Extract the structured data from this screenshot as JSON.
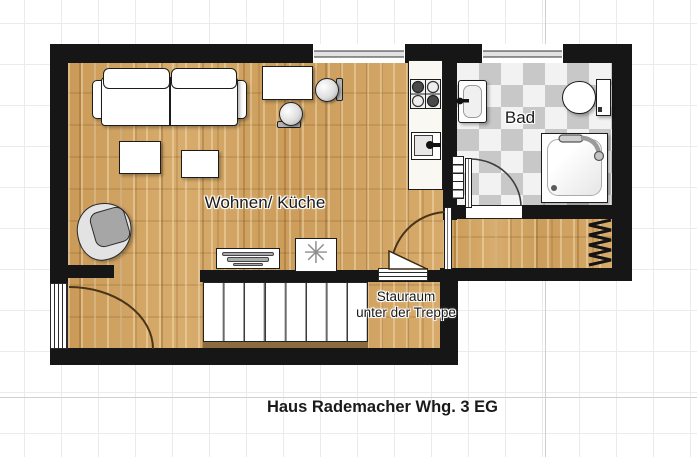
{
  "plan": {
    "caption": "Haus Rademacher Whg. 3 EG",
    "rooms": {
      "living_kitchen": {
        "label": "Wohnen/ Küche"
      },
      "bathroom": {
        "label": "Bad"
      },
      "storage": {
        "label_line1": "Stauraum",
        "label_line2": "unter der Treppe"
      }
    },
    "symbols": {
      "freezer_asterisk": "✳"
    },
    "colors": {
      "wall": "#161616",
      "wood_floor": "#d1a464",
      "tile_dark": "#c8c8c8",
      "tile_light": "#f2f2f2",
      "grid_line": "#ebebeb"
    }
  }
}
